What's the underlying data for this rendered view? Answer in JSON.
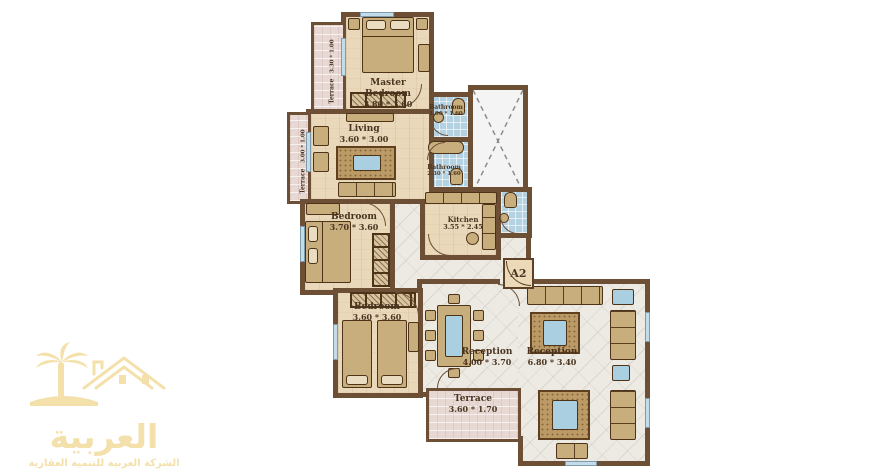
{
  "palette": {
    "wall": "#6d4f35",
    "wood_floor": "#e9d8ba",
    "marble_floor": "#edeae4",
    "bath_tile": "#b5d2e2",
    "terrace_floor": "#e7d8d4",
    "furniture": "#c9ae7d",
    "accent_blue": "#a9cfe0",
    "logo_gold": "#f3e0aa",
    "label_text": "#4a3420"
  },
  "plan": {
    "unit_label": "A2",
    "rooms": [
      {
        "id": "master-bedroom",
        "label": "Master Bedroom",
        "dims": "3.80 * 3.60"
      },
      {
        "id": "living",
        "label": "Living",
        "dims": "3.60 * 3.00"
      },
      {
        "id": "terrace-top",
        "label": "Terrace",
        "dims": "3.30 * 1.00"
      },
      {
        "id": "terrace-mid",
        "label": "Terrace",
        "dims": "3.00 * 1.00"
      },
      {
        "id": "bathroom-top",
        "label": "Bathroom",
        "dims": "1.90 * 1.60"
      },
      {
        "id": "bathroom-mid",
        "label": "Bathroom",
        "dims": "2.30 * 1.60"
      },
      {
        "id": "bedroom-mid",
        "label": "Bedroom",
        "dims": "3.70 * 3.60"
      },
      {
        "id": "kitchen",
        "label": "Kitchen",
        "dims": "3.55 * 2.45"
      },
      {
        "id": "bedroom-bottom",
        "label": "Bedroom",
        "dims": "3.60 * 3.60"
      },
      {
        "id": "reception-dining",
        "label": "Reception",
        "dims": "4.00 * 3.70"
      },
      {
        "id": "reception-living",
        "label": "Reception",
        "dims": "6.80 * 3.40"
      },
      {
        "id": "terrace-bottom",
        "label": "Terrace",
        "dims": "3.60 * 1.70"
      }
    ]
  },
  "logo": {
    "brand": "العربية",
    "tagline": "الشركة العربية للتنمية العقارية"
  }
}
